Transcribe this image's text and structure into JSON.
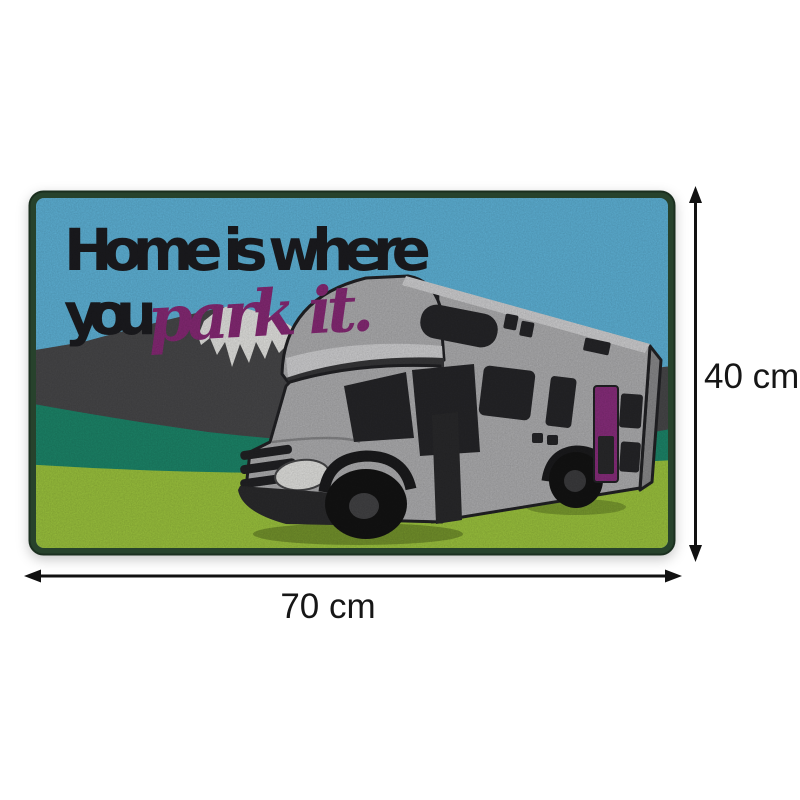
{
  "mat": {
    "text_line1": "Home is where",
    "text_line2": "you",
    "text_script": "park it.",
    "colors": {
      "border_green": "#27422c",
      "sky_blue": "#62b9df",
      "mountain_gray": "#4a4a4c",
      "snow_white": "#ebebe8",
      "hill_teal": "#1e8a6d",
      "grass_lime": "#a1ca40",
      "rv_body_gray": "#b4b4b6",
      "rv_roof_light": "#d7d7d9",
      "rv_window_black": "#27272a",
      "rv_door_purple": "#8d2f80",
      "headline_black": "#1d1d21",
      "script_purple": "#8b2b79",
      "dimension_black": "#161616"
    }
  },
  "dimensions": {
    "height_label": "40 cm",
    "width_label": "70 cm"
  }
}
